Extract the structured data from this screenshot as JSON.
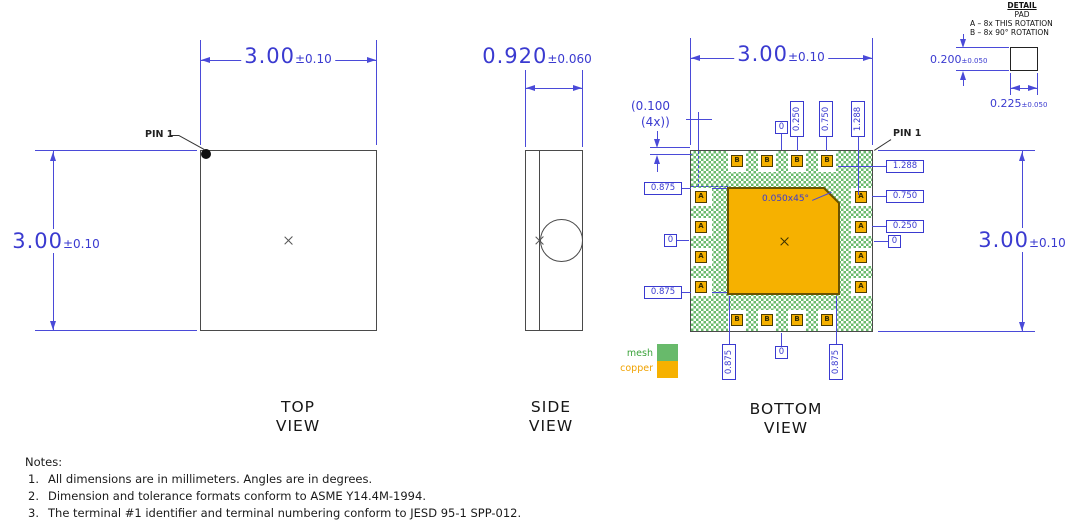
{
  "top_view": {
    "title_line1": "TOP",
    "title_line2": "VIEW",
    "pin1_label": "PIN 1",
    "width_value": "3.00",
    "width_tol": "±0.10",
    "height_value": "3.00",
    "height_tol": "±0.10"
  },
  "side_view": {
    "title_line1": "SIDE",
    "title_line2": "VIEW",
    "width_value": "0.920",
    "width_tol": "±0.060"
  },
  "bottom_view": {
    "title_line1": "BOTTOM",
    "title_line2": "VIEW",
    "pin1_label": "PIN 1",
    "width_value": "3.00",
    "width_tol": "±0.10",
    "height_value": "3.00",
    "height_tol": "±0.10",
    "corner_offset_line1": "(0.100",
    "corner_offset_line2": "(4x))",
    "chamfer_note": "0.050x45°",
    "pad_letter_side": "A",
    "pad_letter_top_bottom": "B",
    "labels_top": [
      "0",
      "0.250",
      "0.750",
      "1.288"
    ],
    "labels_right": [
      "1.288",
      "0.750",
      "0.250",
      "0"
    ],
    "labels_left": [
      "0.875",
      "0",
      "0.875"
    ],
    "labels_bottom": [
      "0.875",
      "0",
      "0.875"
    ],
    "legend_mesh": "mesh",
    "legend_copper": "copper"
  },
  "detail": {
    "title": "DETAIL",
    "subtitle": "PAD",
    "note_a": "A – 8x THIS ROTATION",
    "note_b": "B – 8x 90° ROTATION",
    "height_value": "0.200",
    "height_tol": "±0.050",
    "width_value": "0.225",
    "width_tol": "±0.050"
  },
  "notes": {
    "heading": "Notes:",
    "items": [
      {
        "num": "1.",
        "text": "All dimensions are in millimeters. Angles are in degrees."
      },
      {
        "num": "2.",
        "text": "Dimension and tolerance formats conform to ASME Y14.4M-1994."
      },
      {
        "num": "3.",
        "text": "The terminal #1 identifier and terminal numbering conform to JESD 95-1 SPP-012."
      }
    ]
  },
  "colors": {
    "dimension_blue": "#3a3ad0",
    "mesh_green": "#68ba6b",
    "copper_orange": "#f6b100"
  }
}
